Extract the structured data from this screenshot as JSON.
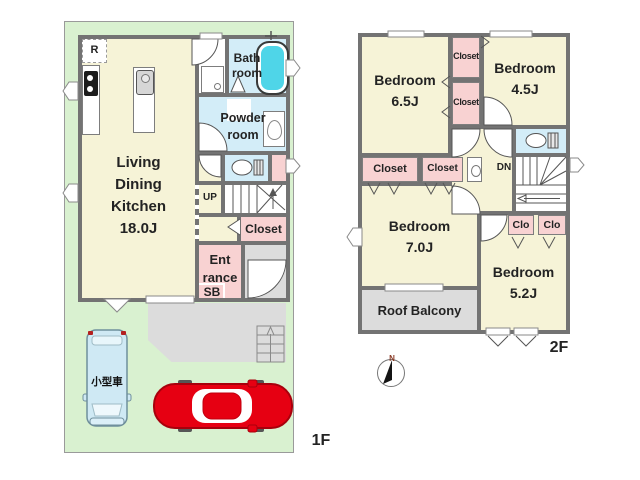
{
  "floor1": {
    "floor_label": "1F",
    "ldk": {
      "l1": "Living",
      "l2": "Dining",
      "l3": "Kitchen",
      "l4": "18.0J"
    },
    "bath": {
      "l1": "Bath",
      "l2": "room"
    },
    "powder": {
      "l1": "Powder",
      "l2": "room"
    },
    "fridge": "R",
    "stairs_up": "UP",
    "closet": "Closet",
    "entrance": {
      "l1": "Ent",
      "l2": "rance"
    },
    "shoe_box": "SB",
    "parking_small_car": "小型車"
  },
  "floor2": {
    "floor_label": "2F",
    "bedroom_65": {
      "l1": "Bedroom",
      "l2": "6.5J"
    },
    "bedroom_45": {
      "l1": "Bedroom",
      "l2": "4.5J"
    },
    "bedroom_70": {
      "l1": "Bedroom",
      "l2": "7.0J"
    },
    "bedroom_52": {
      "l1": "Bedroom",
      "l2": "5.2J"
    },
    "closet_top_a": "Closet",
    "closet_top_b": "Closet",
    "closet_mid_a": "Closet",
    "closet_mid_b": "Closet",
    "clo_a": "Clo",
    "clo_b": "Clo",
    "stairs_down": "DN",
    "roof_balcony": "Roof Balcony"
  },
  "compass": {
    "north": "N"
  },
  "colors": {
    "room_cream": "#f6f3d7",
    "closet_pink": "#f8d2d2",
    "wet_area_blue": "#d3edf8",
    "bathtub_cyan": "#4fd5e8",
    "lot_green": "#d9f1d0",
    "outdoor_gray": "#dcdcdc",
    "wall_gray": "#737373",
    "car_red": "#e60012"
  }
}
